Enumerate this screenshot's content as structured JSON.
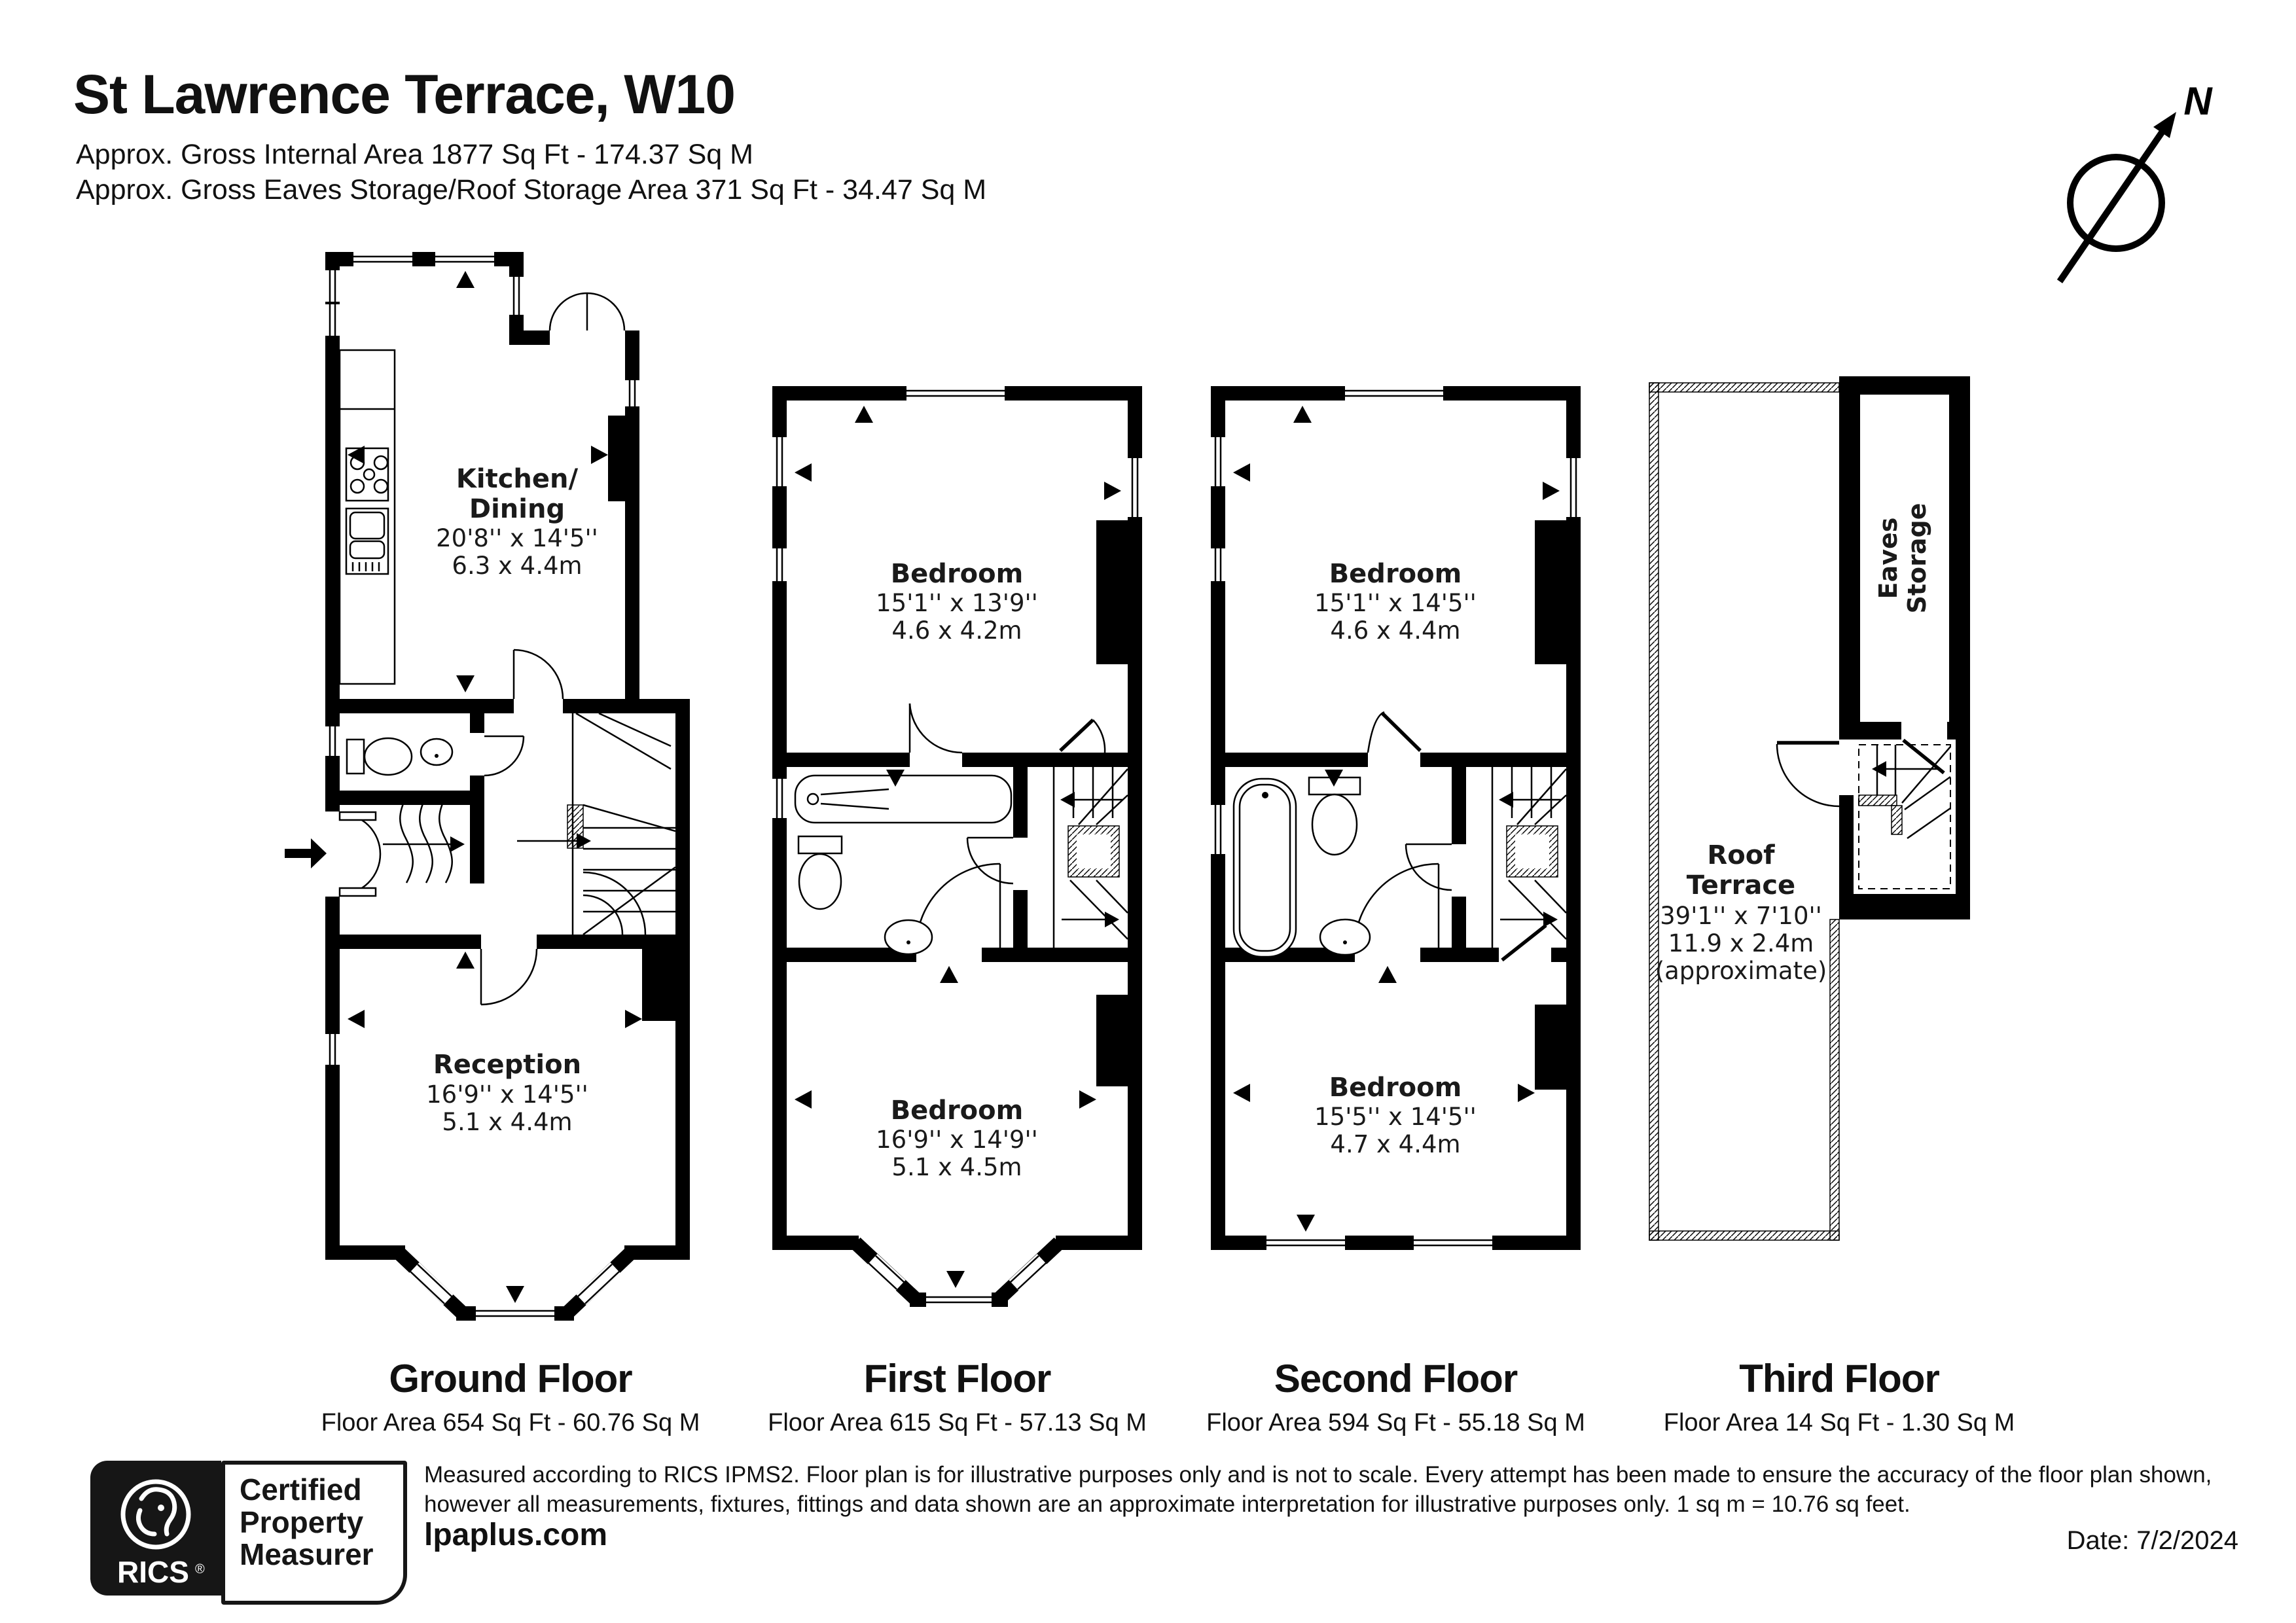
{
  "header": {
    "title": "St Lawrence Terrace, W10",
    "subtitle1": "Approx. Gross Internal Area 1877 Sq Ft - 174.37 Sq M",
    "subtitle2": "Approx. Gross Eaves Storage/Roof Storage Area 371 Sq Ft - 34.47 Sq M"
  },
  "compass": {
    "north_label": "N"
  },
  "floors": {
    "ground": {
      "caption": "Ground Floor",
      "area": "Floor Area 654 Sq Ft - 60.76 Sq M",
      "kitchen": {
        "name_line1": "Kitchen/",
        "name_line2": "Dining",
        "dims_imperial": "20'8'' x 14'5''",
        "dims_metric": "6.3 x 4.4m"
      },
      "reception": {
        "name": "Reception",
        "dims_imperial": "16'9'' x 14'5''",
        "dims_metric": "5.1 x 4.4m"
      }
    },
    "first": {
      "caption": "First Floor",
      "area": "Floor Area 615 Sq Ft - 57.13 Sq M",
      "bedroom_rear": {
        "name": "Bedroom",
        "dims_imperial": "15'1'' x 13'9''",
        "dims_metric": "4.6 x 4.2m"
      },
      "bedroom_front": {
        "name": "Bedroom",
        "dims_imperial": "16'9'' x 14'9''",
        "dims_metric": "5.1 x 4.5m"
      }
    },
    "second": {
      "caption": "Second Floor",
      "area": "Floor Area 594 Sq Ft - 55.18 Sq M",
      "bedroom_rear": {
        "name": "Bedroom",
        "dims_imperial": "15'1'' x 14'5''",
        "dims_metric": "4.6 x 4.4m"
      },
      "bedroom_front": {
        "name": "Bedroom",
        "dims_imperial": "15'5'' x 14'5''",
        "dims_metric": "4.7 x 4.4m"
      }
    },
    "third": {
      "caption": "Third Floor",
      "area": "Floor Area 14 Sq Ft - 1.30 Sq M",
      "roof_terrace": {
        "name_line1": "Roof",
        "name_line2": "Terrace",
        "dims_imperial": "39'1'' x 7'10''",
        "dims_metric": "11.9 x 2.4m",
        "note": "(approximate)"
      },
      "eaves": {
        "name_line1": "Eaves",
        "name_line2": "Storage"
      }
    }
  },
  "footer": {
    "disclaimer_line1": "Measured according to RICS IPMS2. Floor plan is for illustrative purposes only and is not to scale. Every attempt has been made to ensure the accuracy of the floor plan shown,",
    "disclaimer_line2": "however all measurements, fixtures, fittings and data shown are an approximate interpretation for illustrative purposes only. 1 sq m = 10.76 sq feet.",
    "website": "lpaplus.com",
    "date": "Date: 7/2/2024",
    "rics_logo": {
      "brand": "RICS",
      "registered": "®",
      "line1": "Certified",
      "line2": "Property",
      "line3": "Measurer"
    }
  },
  "colors": {
    "wall": "#000000",
    "text": "#1a1a1a",
    "background": "#ffffff"
  }
}
